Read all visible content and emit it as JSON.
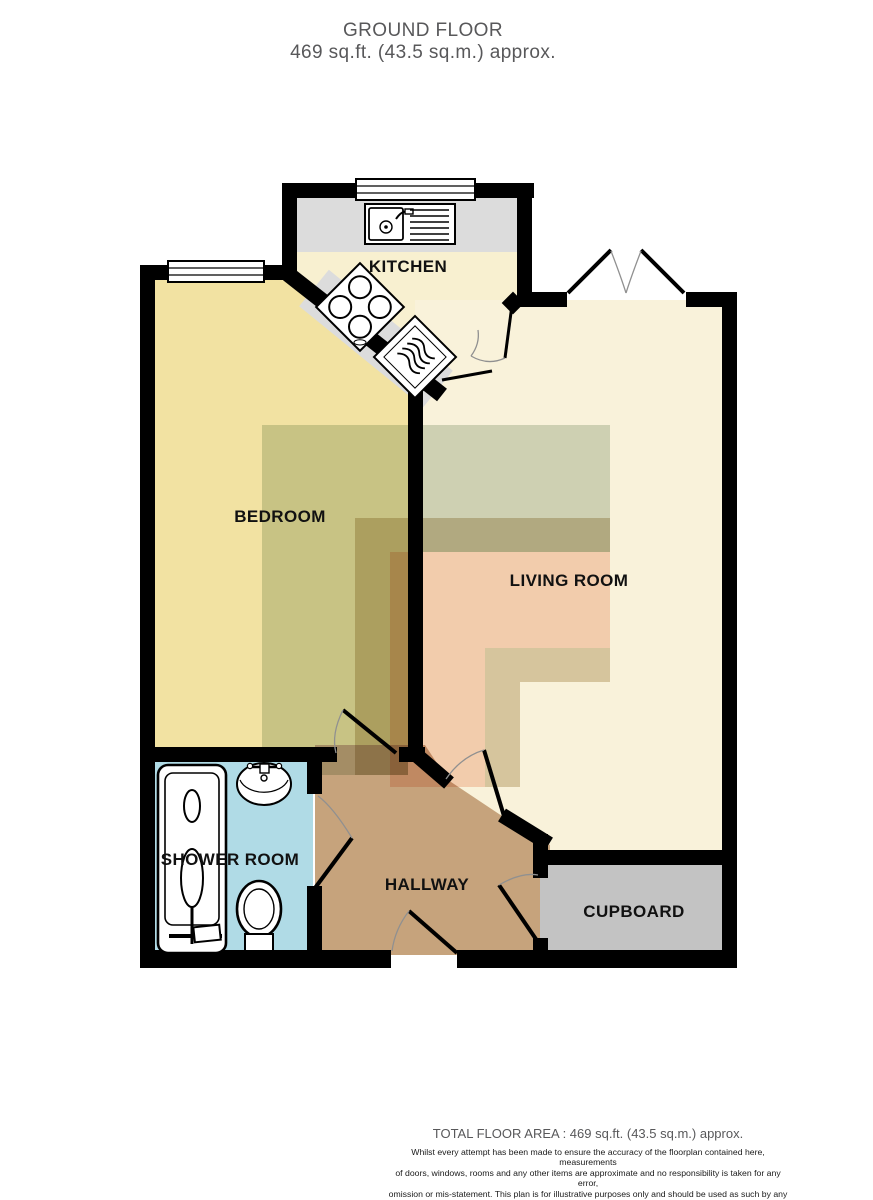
{
  "title": {
    "floor": "GROUND FLOOR",
    "area": "469 sq.ft. (43.5 sq.m.) approx."
  },
  "rooms": {
    "kitchen": "KITCHEN",
    "bedroom": "BEDROOM",
    "living": "LIVING ROOM",
    "shower": "SHOWER ROOM",
    "hallway": "HALLWAY",
    "cupboard": "CUPBOARD"
  },
  "footer": {
    "total": "TOTAL FLOOR AREA : 469 sq.ft. (43.5 sq.m.) approx.",
    "disclaimer_lines": [
      "Whilst every attempt has been made to ensure the accuracy of the floorplan contained here, measurements",
      "of doors, windows, rooms and any other items are approximate and no responsibility is taken for any error,",
      "omission or mis-statement. This plan is for illustrative purposes only and should be used as such by any",
      "prospective purchaser. The services, systems and appliances shown have not been tested and no guarantee",
      "as to their operability or efficiency can be given."
    ],
    "credit": "Made with Metropix ©2025"
  },
  "colors": {
    "wall": "#000000",
    "bedroom": "#f2e2a2",
    "kitchen": "#f8f0d0",
    "counter": "#dcdcdc",
    "living": "#f9f2da",
    "hallway": "#c6a37c",
    "shower_room": "#b0dbe6",
    "cupboard": "#c3c3c3",
    "overlay_green": "#d3dcd0",
    "overlay_tan": "#dbd0b8",
    "overlay_pink": "#f8d7c9",
    "title_text": "#58585a",
    "label_text": "#111111"
  }
}
